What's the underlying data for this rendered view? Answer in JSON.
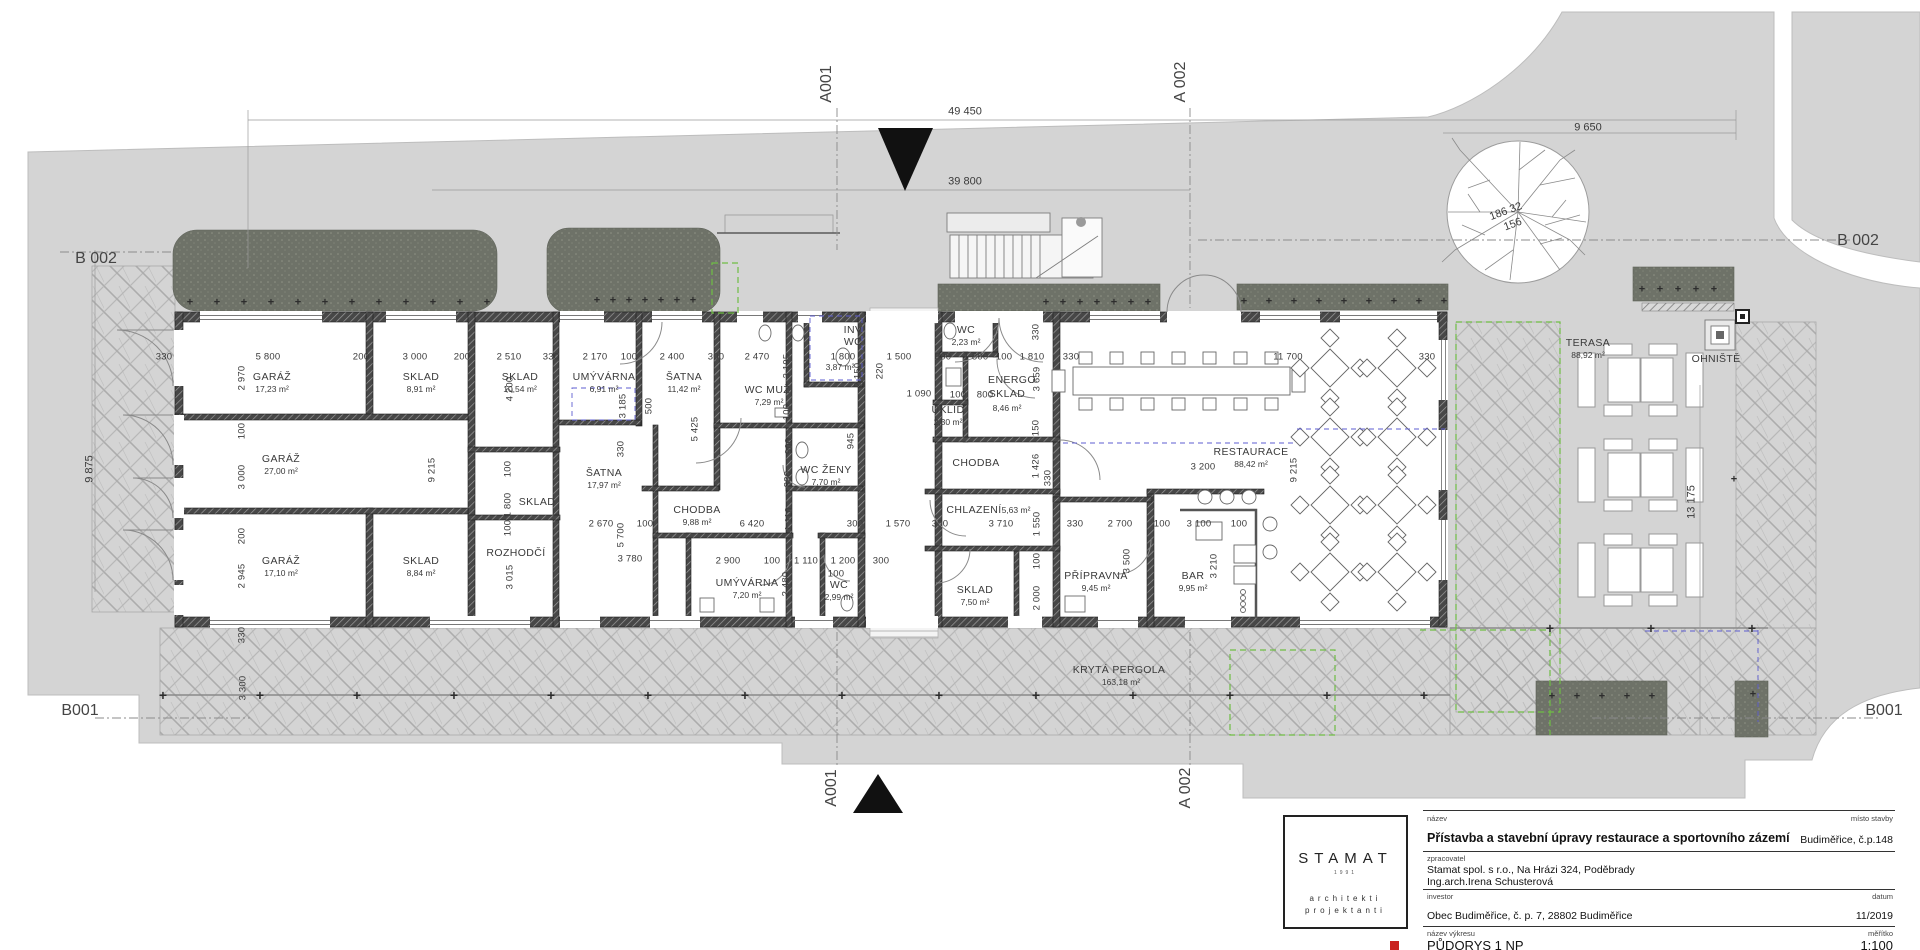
{
  "texts": [
    {
      "t": "A001",
      "x": 827,
      "y": 84,
      "r": -90,
      "k": "mark",
      "dn": "section-marker-a001-top"
    },
    {
      "t": "A 002",
      "x": 1181,
      "y": 82,
      "r": -90,
      "k": "mark",
      "dn": "section-marker-a002-top"
    },
    {
      "t": "A001",
      "x": 832,
      "y": 788,
      "r": -90,
      "k": "mark",
      "dn": "section-marker-a001-bottom"
    },
    {
      "t": "A 002",
      "x": 1186,
      "y": 788,
      "r": -90,
      "k": "mark",
      "dn": "section-marker-a002-bottom"
    },
    {
      "t": "B 002",
      "x": 96,
      "y": 259,
      "k": "mark",
      "dn": "section-marker-b002-left"
    },
    {
      "t": "B 002",
      "x": 1858,
      "y": 241,
      "k": "mark",
      "dn": "section-marker-b002-right"
    },
    {
      "t": "B001",
      "x": 80,
      "y": 711,
      "k": "mark",
      "dn": "section-marker-b001-left"
    },
    {
      "t": "B001",
      "x": 1884,
      "y": 711,
      "k": "mark",
      "dn": "section-marker-b001-right"
    },
    {
      "t": "49 450",
      "x": 965,
      "y": 112,
      "k": "site",
      "dn": "overall-dimension"
    },
    {
      "t": "39 800",
      "x": 965,
      "y": 182,
      "k": "site",
      "dn": "overall-dimension"
    },
    {
      "t": "9 650",
      "x": 1588,
      "y": 128,
      "k": "site",
      "dn": "overall-dimension"
    },
    {
      "t": "9 875",
      "x": 90,
      "y": 469,
      "r": -90,
      "k": "site",
      "dn": "overall-dimension"
    },
    {
      "t": "13 175",
      "x": 1692,
      "y": 502,
      "r": -90,
      "k": "site",
      "dn": "overall-dimension"
    },
    {
      "t": "186 32",
      "x": 1506,
      "y": 212,
      "r": -20,
      "k": "site",
      "dn": "tree-label"
    },
    {
      "t": "156",
      "x": 1513,
      "y": 225,
      "r": -20,
      "k": "site",
      "dn": "tree-label"
    },
    {
      "t": "KRYTÁ PERGOLA",
      "x": 1119,
      "y": 670,
      "k": "lab",
      "dn": "pergola-label"
    },
    {
      "t": "163,18 m²",
      "x": 1121,
      "y": 682,
      "k": "small",
      "dn": "pergola-area"
    },
    {
      "t": "OHNIŠTĚ",
      "x": 1716,
      "y": 359,
      "k": "lab",
      "dn": "firepit-label"
    },
    {
      "t": "5,63 m²",
      "x": 1016,
      "y": 510,
      "k": "small",
      "dn": "room-area"
    },
    {
      "t": "330",
      "x": 164,
      "y": 357
    },
    {
      "t": "5 800",
      "x": 268,
      "y": 357
    },
    {
      "t": "200",
      "x": 361,
      "y": 357
    },
    {
      "t": "3 000",
      "x": 415,
      "y": 357
    },
    {
      "t": "200",
      "x": 462,
      "y": 357
    },
    {
      "t": "2 510",
      "x": 509,
      "y": 357
    },
    {
      "t": "330",
      "x": 551,
      "y": 357
    },
    {
      "t": "2 170",
      "x": 595,
      "y": 357
    },
    {
      "t": "100",
      "x": 629,
      "y": 357
    },
    {
      "t": "2 400",
      "x": 672,
      "y": 357
    },
    {
      "t": "300",
      "x": 716,
      "y": 357
    },
    {
      "t": "2 470",
      "x": 757,
      "y": 357
    },
    {
      "t": "1 800",
      "x": 843,
      "y": 357
    },
    {
      "t": "1 500",
      "x": 899,
      "y": 357
    },
    {
      "t": "300",
      "x": 943,
      "y": 357
    },
    {
      "t": "1 800",
      "x": 976,
      "y": 357
    },
    {
      "t": "100",
      "x": 1004,
      "y": 357
    },
    {
      "t": "1 810",
      "x": 1032,
      "y": 357
    },
    {
      "t": "330",
      "x": 1071,
      "y": 357
    },
    {
      "t": "11 700",
      "x": 1288,
      "y": 357
    },
    {
      "t": "330",
      "x": 1427,
      "y": 357
    },
    {
      "t": "1 090",
      "x": 919,
      "y": 394
    },
    {
      "t": "100",
      "x": 958,
      "y": 395
    },
    {
      "t": "800",
      "x": 985,
      "y": 395
    },
    {
      "t": "2 670",
      "x": 601,
      "y": 524
    },
    {
      "t": "100",
      "x": 645,
      "y": 524
    },
    {
      "t": "6 420",
      "x": 752,
      "y": 524
    },
    {
      "t": "300",
      "x": 855,
      "y": 524
    },
    {
      "t": "1 570",
      "x": 898,
      "y": 524
    },
    {
      "t": "300",
      "x": 940,
      "y": 524
    },
    {
      "t": "3 710",
      "x": 1001,
      "y": 524
    },
    {
      "t": "330",
      "x": 1075,
      "y": 524
    },
    {
      "t": "2 700",
      "x": 1120,
      "y": 524
    },
    {
      "t": "100",
      "x": 1162,
      "y": 524
    },
    {
      "t": "3 100",
      "x": 1199,
      "y": 524
    },
    {
      "t": "100",
      "x": 1239,
      "y": 524
    },
    {
      "t": "3 780",
      "x": 630,
      "y": 559
    },
    {
      "t": "2 900",
      "x": 728,
      "y": 561
    },
    {
      "t": "100",
      "x": 772,
      "y": 561
    },
    {
      "t": "1 110",
      "x": 806,
      "y": 561
    },
    {
      "t": "1 200",
      "x": 843,
      "y": 561
    },
    {
      "t": "100",
      "x": 836,
      "y": 574
    },
    {
      "t": "300",
      "x": 881,
      "y": 561
    },
    {
      "t": "3 200",
      "x": 1203,
      "y": 467
    },
    {
      "t": "2 970",
      "x": 242,
      "y": 378,
      "r": -90
    },
    {
      "t": "100",
      "x": 242,
      "y": 431,
      "r": -90
    },
    {
      "t": "3 000",
      "x": 242,
      "y": 477,
      "r": -90
    },
    {
      "t": "200",
      "x": 242,
      "y": 536,
      "r": -90
    },
    {
      "t": "2 945",
      "x": 242,
      "y": 576,
      "r": -90
    },
    {
      "t": "330",
      "x": 242,
      "y": 635,
      "r": -90
    },
    {
      "t": "3 300",
      "x": 243,
      "y": 688,
      "r": -90
    },
    {
      "t": "9 215",
      "x": 432,
      "y": 470,
      "r": -90
    },
    {
      "t": "4 200",
      "x": 510,
      "y": 389,
      "r": -90
    },
    {
      "t": "100",
      "x": 508,
      "y": 469,
      "r": -90
    },
    {
      "t": "1 800",
      "x": 508,
      "y": 505,
      "r": -90
    },
    {
      "t": "100",
      "x": 508,
      "y": 528,
      "r": -90
    },
    {
      "t": "3 015",
      "x": 510,
      "y": 577,
      "r": -90
    },
    {
      "t": "3 185",
      "x": 623,
      "y": 406,
      "r": -90
    },
    {
      "t": "500",
      "x": 649,
      "y": 406,
      "r": -90
    },
    {
      "t": "330",
      "x": 621,
      "y": 449,
      "r": -90
    },
    {
      "t": "5 700",
      "x": 621,
      "y": 535,
      "r": -90
    },
    {
      "t": "5 425",
      "x": 695,
      "y": 429,
      "r": -90
    },
    {
      "t": "3 195",
      "x": 787,
      "y": 366,
      "r": -90
    },
    {
      "t": "100",
      "x": 787,
      "y": 412,
      "r": -90
    },
    {
      "t": "900",
      "x": 789,
      "y": 446,
      "r": -90
    },
    {
      "t": "330",
      "x": 788,
      "y": 479,
      "r": -90
    },
    {
      "t": "1 110",
      "x": 789,
      "y": 519,
      "r": -90
    },
    {
      "t": "2 480",
      "x": 786,
      "y": 584,
      "r": -90
    },
    {
      "t": "2 150",
      "x": 858,
      "y": 375,
      "r": -90
    },
    {
      "t": "220",
      "x": 880,
      "y": 371,
      "r": -90
    },
    {
      "t": "945",
      "x": 851,
      "y": 441,
      "r": -90
    },
    {
      "t": "330",
      "x": 1036,
      "y": 332,
      "r": -90
    },
    {
      "t": "3 659",
      "x": 1037,
      "y": 379,
      "r": -90
    },
    {
      "t": "150",
      "x": 1036,
      "y": 428,
      "r": -90
    },
    {
      "t": "1 426",
      "x": 1036,
      "y": 466,
      "r": -90
    },
    {
      "t": "330",
      "x": 1048,
      "y": 478,
      "r": -90
    },
    {
      "t": "1 550",
      "x": 1037,
      "y": 524,
      "r": -90
    },
    {
      "t": "100",
      "x": 1037,
      "y": 561,
      "r": -90
    },
    {
      "t": "2 000",
      "x": 1037,
      "y": 598,
      "r": -90
    },
    {
      "t": "3 500",
      "x": 1127,
      "y": 561,
      "r": -90
    },
    {
      "t": "3 210",
      "x": 1214,
      "y": 566,
      "r": -90
    },
    {
      "t": "9 215",
      "x": 1294,
      "y": 470,
      "r": -90
    }
  ],
  "rooms": [
    {
      "n": "GARÁŽ",
      "a": "17,23 m²",
      "x": 272,
      "y": 377
    },
    {
      "n": "SKLAD",
      "a": "8,91 m²",
      "x": 421,
      "y": 377
    },
    {
      "n": "GARÁŽ",
      "a": "27,00 m²",
      "x": 281,
      "y": 459
    },
    {
      "n": "GARÁŽ",
      "a": "17,10 m²",
      "x": 281,
      "y": 561
    },
    {
      "n": "SKLAD",
      "a": "8,84 m²",
      "x": 421,
      "y": 561
    },
    {
      "n": "SKLAD",
      "a": "10,54 m²",
      "x": 520,
      "y": 377
    },
    {
      "n": "UMÝVÁRNA",
      "a": "6,91 m²",
      "x": 604,
      "y": 377
    },
    {
      "n": "ŠATNA",
      "a": "11,42 m²",
      "x": 684,
      "y": 377
    },
    {
      "n": "WC MUŽI",
      "a": "7,29 m²",
      "x": 769,
      "y": 390
    },
    {
      "n": "SKLAD",
      "x": 537,
      "y": 502
    },
    {
      "n": "ROZHODČÍ",
      "x": 516,
      "y": 553
    },
    {
      "n": "ŠATNA",
      "a": "17,97 m²",
      "x": 604,
      "y": 473
    },
    {
      "n": "CHODBA",
      "a": "9,88 m²",
      "x": 697,
      "y": 510
    },
    {
      "n": "UMÝVÁRNA",
      "a": "7,20 m²",
      "x": 747,
      "y": 583
    },
    {
      "n": "INV",
      "x": 853,
      "y": 330
    },
    {
      "n": "WC",
      "a": "3,87 m²",
      "x": 853,
      "y": 342,
      "ax": 840,
      "ay": 367
    },
    {
      "n": "WC ŽENY",
      "a": "7,70 m²",
      "x": 826,
      "y": 470
    },
    {
      "n": "WC",
      "a": "2,99 m²",
      "x": 839,
      "y": 585
    },
    {
      "n": "WC",
      "a": "2,23 m²",
      "x": 966,
      "y": 330
    },
    {
      "n": "ÚKLID",
      "a": "2,30 m²",
      "x": 948,
      "y": 410
    },
    {
      "n": "ENERGO",
      "x": 1012,
      "y": 380
    },
    {
      "n": "SKLAD",
      "a": "8,46 m²",
      "x": 1007,
      "y": 394,
      "ay": 408
    },
    {
      "n": "CHODBA",
      "x": 976,
      "y": 463
    },
    {
      "n": "CHLAZENÍ",
      "x": 974,
      "y": 510
    },
    {
      "n": "SKLAD",
      "a": "7,50 m²",
      "x": 975,
      "y": 590
    },
    {
      "n": "PŘÍPRAVNA",
      "a": "9,45 m²",
      "x": 1096,
      "y": 576
    },
    {
      "n": "BAR",
      "a": "9,95 m²",
      "x": 1193,
      "y": 576
    },
    {
      "n": "RESTAURACE",
      "a": "88,42 m²",
      "x": 1251,
      "y": 452
    },
    {
      "n": "TERASA",
      "a": "88,92 m²",
      "x": 1588,
      "y": 343
    }
  ],
  "plant_rows": [
    {
      "y": 303,
      "x1": 190,
      "x2": 488,
      "step": 27
    },
    {
      "y": 301,
      "x1": 597,
      "x2": 707,
      "step": 16
    },
    {
      "y": 303,
      "x1": 1046,
      "x2": 1148,
      "step": 17
    },
    {
      "y": 302,
      "x1": 1244,
      "x2": 1444,
      "step": 25
    },
    {
      "y": 290,
      "x1": 1642,
      "x2": 1730,
      "step": 18
    },
    {
      "y": 697,
      "x1": 1552,
      "x2": 1652,
      "step": 25
    },
    {
      "y": 695,
      "x1": 163,
      "x2": 1448,
      "step": 97,
      "big": true
    },
    {
      "y": 695,
      "x1": 1753,
      "x2": 1753,
      "step": 50
    },
    {
      "y": 628,
      "x1": 1550,
      "x2": 1753,
      "step": 101,
      "big": true
    },
    {
      "y": 480,
      "x1": 1734,
      "x2": 1734,
      "step": 50
    }
  ],
  "title_block": {
    "logo": {
      "name": "STAMAT",
      "year": "1991",
      "line1": "architekti",
      "line2": "projektanti"
    },
    "fields": {
      "nazev_label": "název",
      "misto_label": "místo stavby",
      "nazev": "Přístavba a stavební úpravy restaurace a sportovního zázemí",
      "misto": "Budiměřice, č.p.148",
      "zprac_label": "zpracovatel",
      "zprac1": "Stamat spol. s r.o., Na Hrázi 324, Poděbrady",
      "zprac2": "Ing.arch.Irena Schusterová",
      "inv_label": "investor",
      "datum_label": "datum",
      "investor": "Obec Budiměřice, č. p. 7, 28802 Budiměřice",
      "datum": "11/2019",
      "vykres_label": "název výkresu",
      "meritko_label": "měřítko",
      "vykres": "PŮDORYS 1 NP",
      "meritko": "1:100"
    }
  }
}
